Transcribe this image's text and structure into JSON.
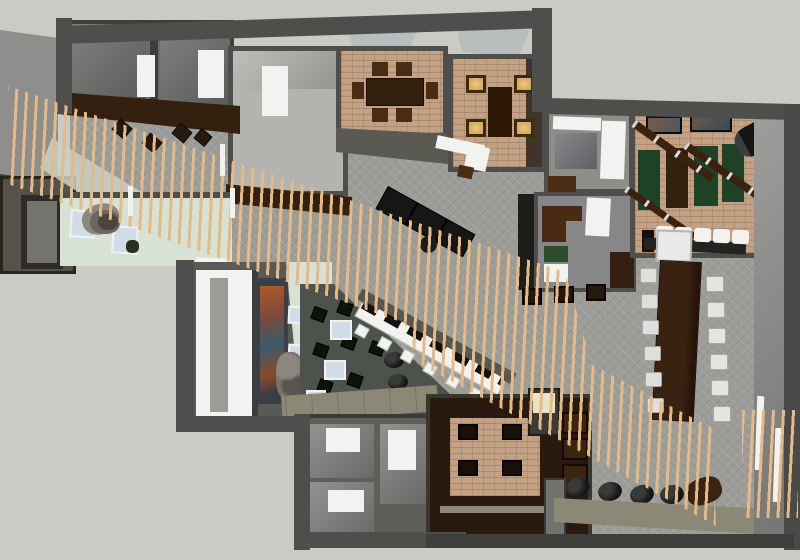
{
  "scene": {
    "type": "3d-floor-plan-render",
    "description": "Overhead SketchUp-style rendering of an interior floor plan with a diagonal wood-slat canopy crossing the space",
    "rooms": [
      "phone-rooms",
      "reception-room",
      "dining-room-a",
      "dining-room-b",
      "office-room",
      "meeting-nook",
      "game-room",
      "conference-area",
      "entry-vestibule",
      "gallery-corridor",
      "lounge-pit",
      "storage-rooms",
      "walnut-private-room",
      "open-plan-carpet"
    ],
    "features": [
      "wood-slat-canopy",
      "skylights",
      "diagonal-bar-counter",
      "boulder-sculpture",
      "mural-wall",
      "shuffleboard-beams",
      "pouf-row",
      "conference-table",
      "bar-stool-row"
    ]
  },
  "palette": {
    "bg": "#cbcac5",
    "wall-dark": "#3d3d3b",
    "wall-mid": "#4e4e4c",
    "wall-gray": "#6d6d6b",
    "wall-face": "#8e8e8c",
    "wall-olive": "#5a5a52",
    "floor-carpet": "#9c9c98",
    "floor-lightgray": "#b3b3b0",
    "floor-gray": "#87878a",
    "floor-brick": "#c2a184",
    "floor-walnut": "#2a190e",
    "floor-mint": "#d8e2d4",
    "floor-lounge": "#4e524c",
    "wood-dark": "#33200f",
    "wood-mid": "#4a2c14",
    "slat": "#e5ba84",
    "white": "#f2f2f0",
    "cream": "#eae2c8",
    "glow": "#f2c87c",
    "green-mat": "#1d4226",
    "black": "#161616",
    "olive": "#8b8876",
    "blue": "#cfdde8",
    "stone": "#6b665f",
    "glass": "#c7d2c9",
    "cube": "#0d120c",
    "mural-warm": "#b05a2a",
    "mural-cool": "#3a5a6a"
  }
}
